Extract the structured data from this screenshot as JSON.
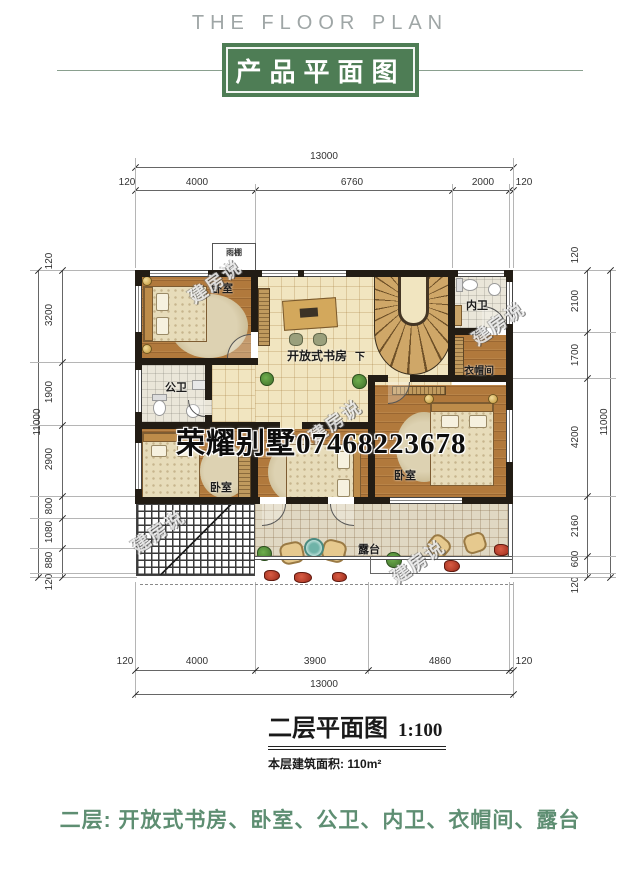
{
  "header": {
    "subtitle": "THE FLOOR PLAN",
    "title": "产品平面图"
  },
  "dims": {
    "top": {
      "total": "13000",
      "segments": [
        "120",
        "4000",
        "6760",
        "2000",
        "120"
      ]
    },
    "bottom": {
      "total": "13000",
      "segments": [
        "120",
        "4000",
        "3900",
        "4860",
        "120"
      ]
    },
    "left": {
      "total": "11000",
      "segments": [
        "120",
        "3200",
        "1900",
        "2900",
        "800",
        "1080",
        "880",
        "120"
      ]
    },
    "right": {
      "total": "11000",
      "segments": [
        "120",
        "2100",
        "1700",
        "4200",
        "2160",
        "600",
        "120"
      ]
    }
  },
  "rooms": [
    {
      "id": "bedroom-top-left",
      "label": "卧室"
    },
    {
      "id": "study-open",
      "label": "开放式书房"
    },
    {
      "id": "bath-public",
      "label": "公卫"
    },
    {
      "id": "bath-inner",
      "label": "内卫"
    },
    {
      "id": "cloakroom",
      "label": "衣帽间"
    },
    {
      "id": "bedroom-bottom-left",
      "label": "卧室"
    },
    {
      "id": "bedroom-bottom-right",
      "label": "卧室"
    },
    {
      "id": "terrace",
      "label": "露台"
    }
  ],
  "annotations": {
    "canopy": "雨棚",
    "stairs_down": "下"
  },
  "watermarks": {
    "phone": "荣耀别墅07468223678",
    "brand": "建房说"
  },
  "caption": {
    "title": "二层平面图",
    "scale": "1:100",
    "area": "本层建筑面积: 110m²"
  },
  "footer": {
    "text": "二层: 开放式书房、卧室、公卫、内卫、衣帽间、露台"
  },
  "colors": {
    "accent_green": "#4e7d55",
    "footer_green": "#5e8e72",
    "wood": "#b1793c",
    "tile_cream": "#f1e5c0"
  }
}
